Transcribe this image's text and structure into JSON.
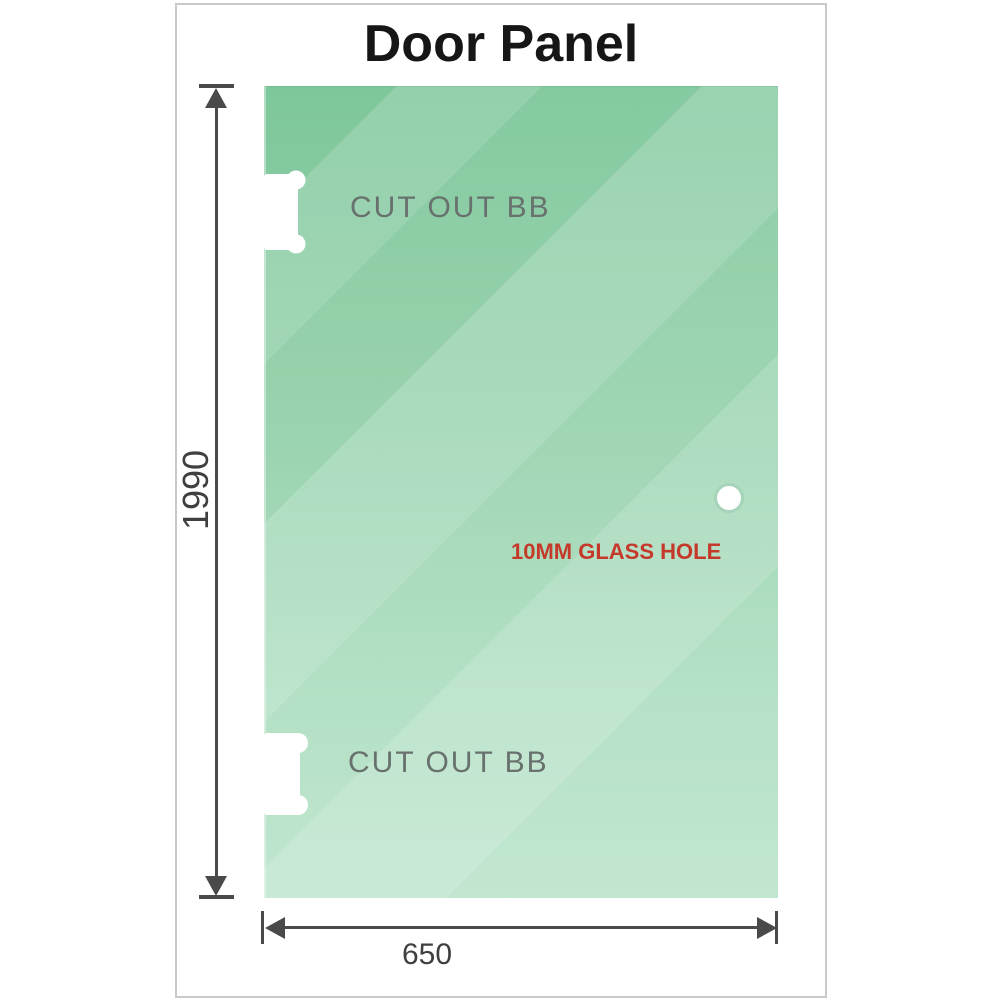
{
  "title": "Door Panel",
  "diagram": {
    "type": "technical-drawing",
    "subject": "glass shower door panel",
    "panel": {
      "glass_color_top": "#7ec79b",
      "glass_color_bottom": "#b9e3ca",
      "height_label": "1990",
      "width_label": "650"
    },
    "cutouts": [
      {
        "label": "CUT OUT BB",
        "position": "top-left-edge"
      },
      {
        "label": "CUT OUT BB",
        "position": "bottom-left-edge"
      }
    ],
    "hole": {
      "label": "10MM GLASS HOLE",
      "label_color": "#c5392b"
    },
    "dimension_color": "#4a4a4a",
    "frame_border_color": "#c9c9c9"
  }
}
